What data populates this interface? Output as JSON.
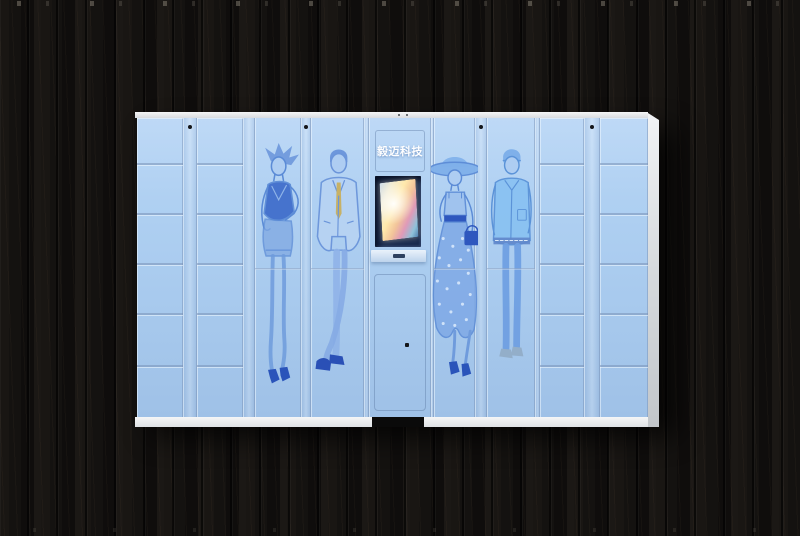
{
  "scene": {
    "description": "Light-blue smart parcel locker cabinet with fashion-sketch artwork, photographed on a black wooden plank wall"
  },
  "brand": {
    "name": "毅迈科技"
  },
  "cabinet": {
    "face_color": "#aacdf1",
    "frame_color": "#e9ecef",
    "background_wood_color": "#121010",
    "has_center_base_notch": true
  },
  "kiosk": {
    "screen": "touch-screen",
    "screen_frame_color": "#1a2c50",
    "tray": "pickup-tray",
    "slot": "card-slot"
  },
  "locker": {
    "row_heights": [
      47,
      50,
      50,
      50,
      52,
      50
    ],
    "tall_seam_y": 150,
    "lock_dot_color": "#14161a",
    "columns": [
      {
        "type": "small",
        "rows": 6,
        "w": 46
      },
      {
        "type": "strip",
        "w": 14,
        "dot": true
      },
      {
        "type": "small",
        "rows": 6,
        "w": 46
      },
      {
        "type": "strip",
        "w": 12,
        "dot": false
      },
      {
        "type": "tall",
        "w": 46,
        "figure": "woman-dress"
      },
      {
        "type": "strip",
        "w": 10,
        "dot": true
      },
      {
        "type": "tall",
        "w": 53,
        "figure": "man-suit"
      },
      {
        "type": "strip",
        "w": 5,
        "dot": false
      },
      {
        "type": "console",
        "w": 62
      },
      {
        "type": "strip",
        "w": 3,
        "dot": false
      },
      {
        "type": "tall",
        "w": 41,
        "figure": "woman-hat"
      },
      {
        "type": "strip",
        "w": 12,
        "dot": true
      },
      {
        "type": "tall",
        "w": 48,
        "figure": "man-jacket"
      },
      {
        "type": "strip",
        "w": 5,
        "dot": false
      },
      {
        "type": "small",
        "rows": 6,
        "w": 44
      },
      {
        "type": "strip",
        "w": 16,
        "dot": true
      },
      {
        "type": "small",
        "rows": 6,
        "w": 48
      }
    ]
  },
  "figures": [
    {
      "id": "woman-dress",
      "desc": "woman in sleeveless dark top and shorts, high heels"
    },
    {
      "id": "man-suit",
      "desc": "man in light suit with khaki tie, crossed legs, blue shoes"
    },
    {
      "id": "woman-hat",
      "desc": "woman in wide-brim hat, polka-dot long skirt, handbag, heels"
    },
    {
      "id": "man-jacket",
      "desc": "man in beanie and casual jacket, skinny jeans, loafers"
    }
  ],
  "colors": {
    "figure_ink": "#5b8bd6",
    "figure_dark_fill": "#3e6cca",
    "tie": "#c7b166",
    "shoes": "#2a54ba",
    "waistband_bag": "#2e57be"
  }
}
